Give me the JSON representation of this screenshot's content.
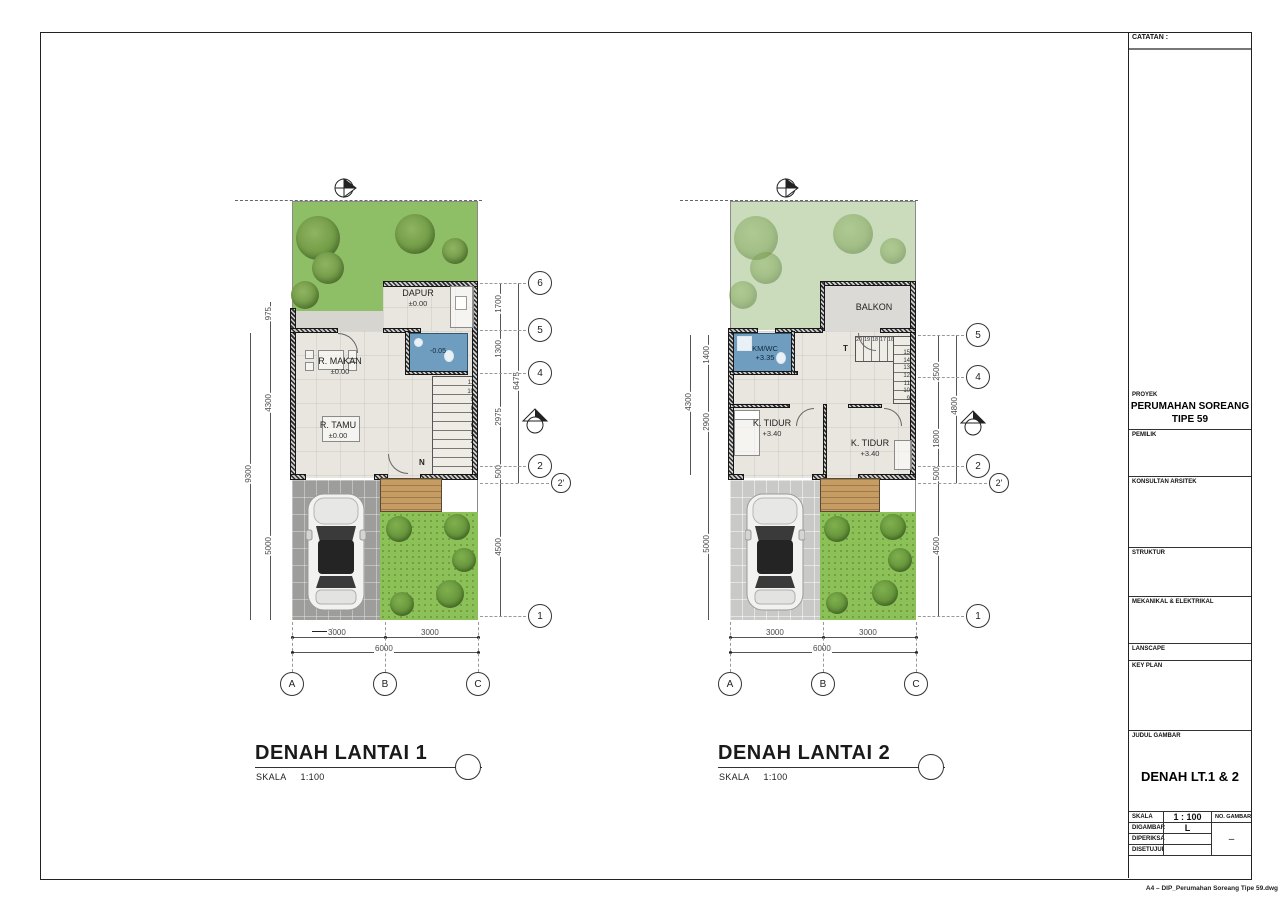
{
  "titleblock": {
    "catatan_label": "CATATAN :",
    "proyek_label": "PROYEK",
    "proyek_line1": "PERUMAHAN SOREANG",
    "proyek_line2": "TIPE 59",
    "pemilik_label": "PEMILIK",
    "konsultan_label": "KONSULTAN ARSITEK",
    "struktur_label": "STRUKTUR",
    "mekanikal_label": "MEKANIKAL & ELEKTRIKAL",
    "lanscape_label": "LANSCAPE",
    "keyplan_label": "KEY PLAN",
    "judul_label": "JUDUL GAMBAR",
    "judul_value": "DENAH LT.1 & 2",
    "skala_label": "SKALA",
    "skala_value": "1 : 100",
    "no_gambar_label": "NO. GAMBAR",
    "no_gambar_value": "–",
    "digambar_label": "DIGAMBAR",
    "digambar_value": "L",
    "diperiksa_label": "DIPERIKSA",
    "disetujui_label": "DISETUJUI",
    "footer_note": "A4 – DIP_Perumahan Soreang Tipe 59.dwg"
  },
  "plan1": {
    "title": "DENAH LANTAI 1",
    "scale_label": "SKALA",
    "scale_value": "1:100",
    "rooms": {
      "dapur": "DAPUR",
      "dapur_level": "±0.00",
      "makan": "R. MAKAN",
      "makan_level": "±0.00",
      "tamu": "R. TAMU",
      "tamu_level": "±0.00",
      "kmwc_level": "-0.05"
    },
    "stair_label": "N",
    "stair_numbers": [
      "11",
      "10",
      "9",
      "8",
      "7",
      "6",
      "5",
      "4",
      "3",
      "2",
      "1"
    ],
    "dims": {
      "left_975": "975",
      "left_4300": "4300",
      "left_5000": "5000",
      "left_total_9300": "9300",
      "right_1700": "1700",
      "right_1300": "1300",
      "right_2975": "2975",
      "right_500": "500",
      "right_total_6475": "6475",
      "right_lower_4500": "4500",
      "bottom_3000a": "3000",
      "bottom_3000b": "3000",
      "bottom_total_6000": "6000"
    },
    "grid": {
      "g6": "6",
      "g5": "5",
      "g4": "4",
      "g2": "2",
      "g2p": "2'",
      "g1": "1",
      "gA": "A",
      "gB": "B",
      "gC": "C"
    }
  },
  "plan2": {
    "title": "DENAH LANTAI 2",
    "scale_label": "SKALA",
    "scale_value": "1:100",
    "rooms": {
      "balkon": "BALKON",
      "kmwc": "KM/WC",
      "kmwc_level": "+3.35",
      "tidur1": "K. TIDUR",
      "tidur1_level": "+3.40",
      "tidur2": "K. TIDUR",
      "tidur2_level": "+3.40"
    },
    "stair_label": "T",
    "stair_numbers_top": [
      "20",
      "19",
      "18",
      "17",
      "16"
    ],
    "stair_numbers_side": [
      "15",
      "14",
      "13",
      "12",
      "11",
      "10",
      "9"
    ],
    "dims": {
      "left_1400": "1400",
      "left_2900": "2900",
      "left_total_4300": "4300",
      "left_lower_5000": "5000",
      "right_2500": "2500",
      "right_1800": "1800",
      "right_500": "500",
      "right_total_4800": "4800",
      "right_lower_4500": "4500",
      "bottom_3000a": "3000",
      "bottom_3000b": "3000",
      "bottom_total_6000": "6000"
    },
    "grid": {
      "g5": "5",
      "g4": "4",
      "g2": "2",
      "g2p": "2'",
      "g1": "1",
      "gA": "A",
      "gB": "B",
      "gC": "C"
    }
  },
  "colors": {
    "garden_green": "#8ebf66",
    "garden_green_faded": "#cadcbb",
    "lawn_green": "#8cc158",
    "bathroom_blue": "#6e9dc0",
    "deck_wood": "#c79c63",
    "paver_gray": "#9d9d9b",
    "paver_gray_light": "#c9c9c7",
    "wall_dark": "#2b2b2b"
  }
}
